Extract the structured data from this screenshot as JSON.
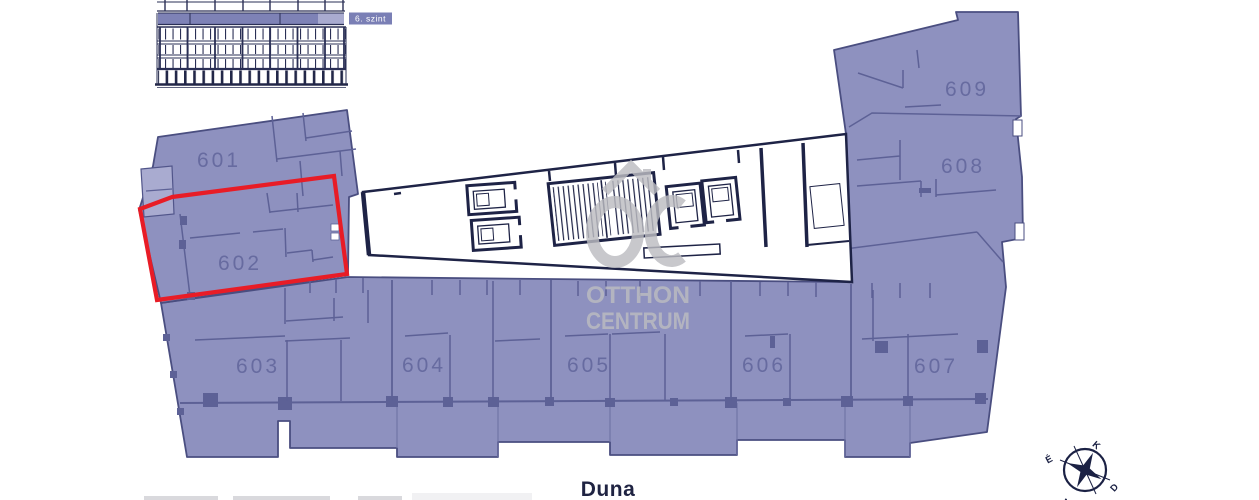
{
  "elevation": {
    "floor_label": "6. szint"
  },
  "plan": {
    "apartments": [
      {
        "number": "601",
        "highlighted": false
      },
      {
        "number": "602",
        "highlighted": true
      },
      {
        "number": "603",
        "highlighted": false
      },
      {
        "number": "604",
        "highlighted": false
      },
      {
        "number": "605",
        "highlighted": false
      },
      {
        "number": "606",
        "highlighted": false
      },
      {
        "number": "607",
        "highlighted": false
      },
      {
        "number": "608",
        "highlighted": false
      },
      {
        "number": "609",
        "highlighted": false
      }
    ],
    "highlighted_apartment": "602"
  },
  "watermark": {
    "line1": "OTTHON",
    "line2": "CENTRUM"
  },
  "river_label": "Duna",
  "compass": {
    "north": "É",
    "east": "K",
    "south": "D",
    "west": "Ny"
  },
  "colors": {
    "apartment_fill": "#8e91bf",
    "apartment_fill_light": "#a9abd0",
    "block_outline": "#4a4e80",
    "interior_wall": "#5d6196",
    "corridor_wall": "#1e2346",
    "highlight_red": "#e81c26",
    "label_purple": "#676ba0",
    "watermark_gray": "#bcbcc1",
    "navy_text": "#1f2342",
    "floor_band": "#7e82b6"
  }
}
